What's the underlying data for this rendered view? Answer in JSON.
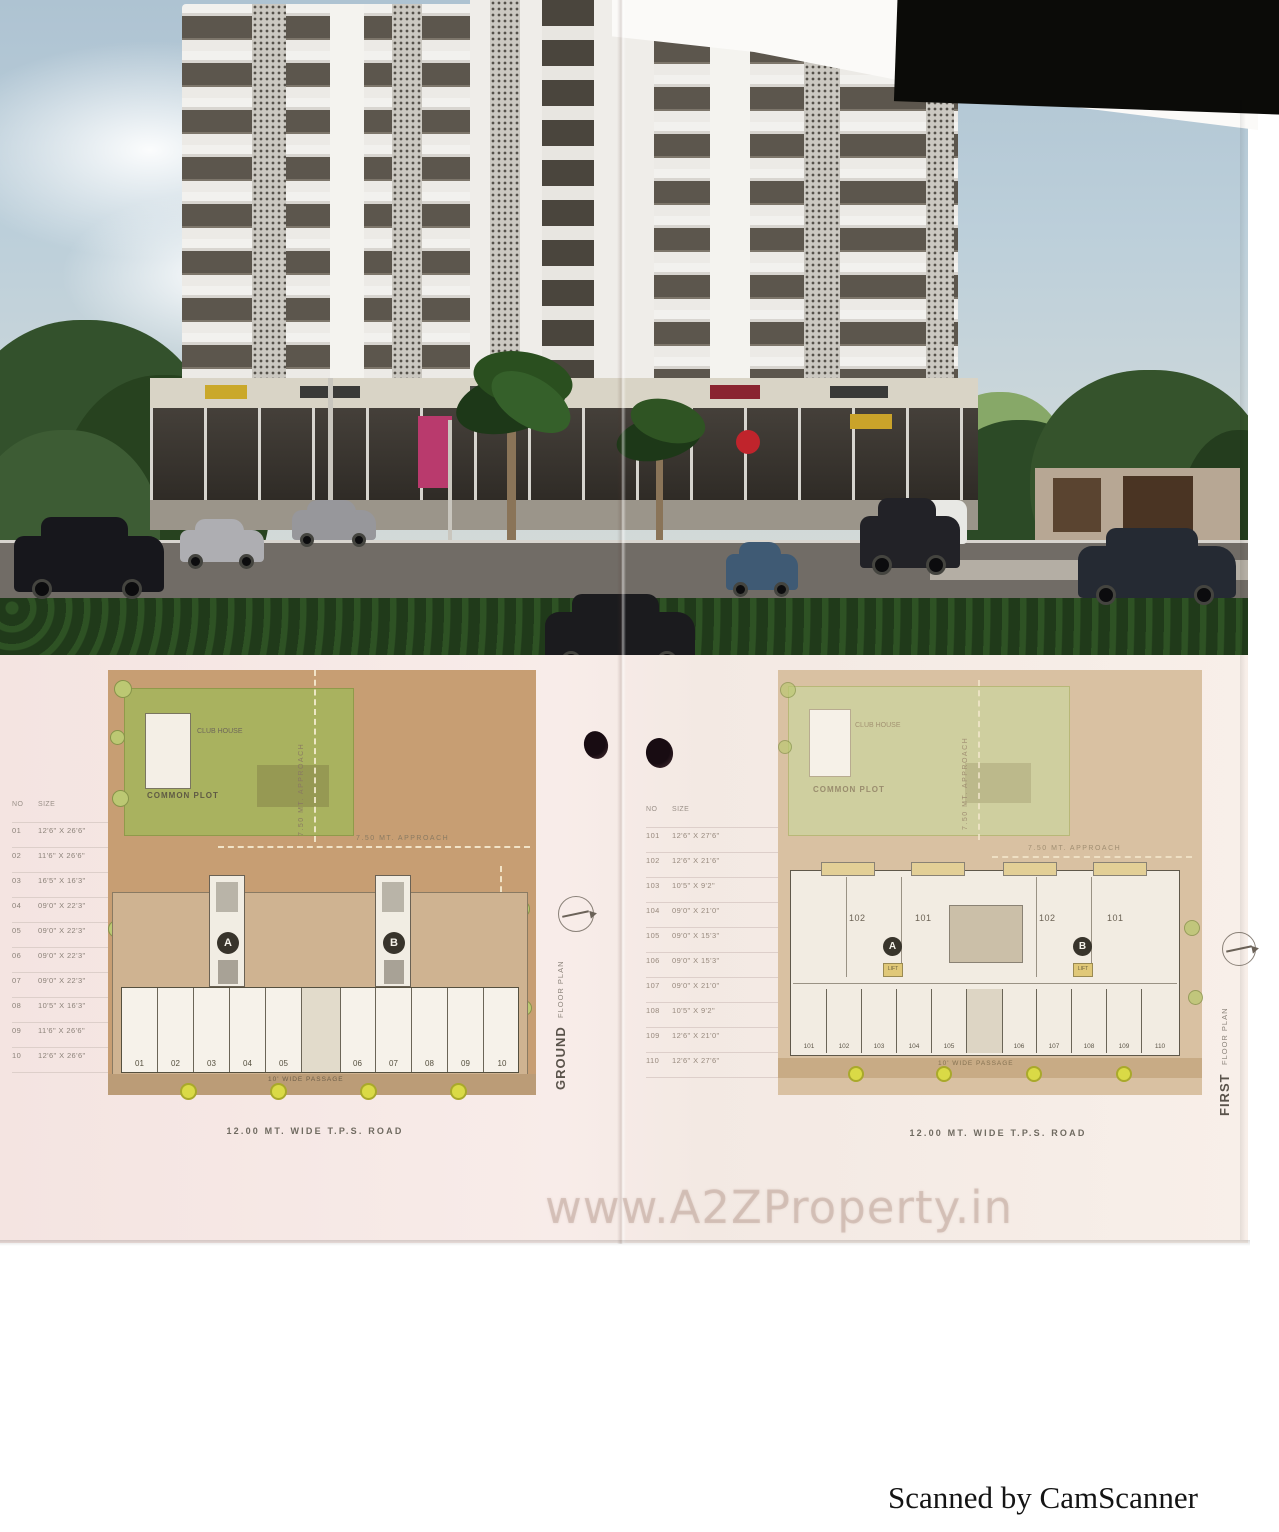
{
  "scan": {
    "watermark": "www.A2ZProperty.in",
    "credit": "Scanned by CamScanner"
  },
  "ground_plan": {
    "title": "GROUND",
    "title_rest": "FLOOR PLAN",
    "road_label": "12.00 MT. WIDE T.P.S. ROAD",
    "approach_label": "7.50 MT. APPROACH",
    "common_plot_label": "COMMON PLOT",
    "club_house_label": "CLUB HOUSE",
    "passage_label": "10' WIDE PASSAGE",
    "tower_a": "A",
    "tower_b": "B",
    "shops": [
      "01",
      "02",
      "03",
      "04",
      "05",
      "06",
      "07",
      "08",
      "09",
      "10"
    ],
    "table": {
      "no_header": "NO",
      "size_header": "SIZE",
      "rows": [
        {
          "no": "01",
          "size": "12'6\" X 26'6\""
        },
        {
          "no": "02",
          "size": "11'6\" X 26'6\""
        },
        {
          "no": "03",
          "size": "16'5\" X 16'3\""
        },
        {
          "no": "04",
          "size": "09'0\" X 22'3\""
        },
        {
          "no": "05",
          "size": "09'0\" X 22'3\""
        },
        {
          "no": "06",
          "size": "09'0\" X 22'3\""
        },
        {
          "no": "07",
          "size": "09'0\" X 22'3\""
        },
        {
          "no": "08",
          "size": "10'5\" X 16'3\""
        },
        {
          "no": "09",
          "size": "11'6\" X 26'6\""
        },
        {
          "no": "10",
          "size": "12'6\" X 26'6\""
        }
      ]
    }
  },
  "first_plan": {
    "title": "FIRST",
    "title_rest": "FLOOR PLAN",
    "road_label": "12.00 MT. WIDE T.P.S. ROAD",
    "approach_label": "7.50 MT. APPROACH",
    "common_plot_label": "COMMON PLOT",
    "club_house_label": "CLUB HOUSE",
    "passage_label": "10' WIDE PASSAGE",
    "lift_label": "LIFT",
    "tower_a": "A",
    "tower_b": "B",
    "units": [
      "102",
      "101",
      "102",
      "101"
    ],
    "rooms": [
      "101",
      "102",
      "103",
      "104",
      "105",
      "106",
      "107",
      "108",
      "109",
      "110"
    ],
    "table": {
      "no_header": "NO",
      "size_header": "SIZE",
      "rows": [
        {
          "no": "101",
          "size": "12'6\" X 27'6\""
        },
        {
          "no": "102",
          "size": "12'6\" X 21'6\""
        },
        {
          "no": "103",
          "size": "10'5\" X 9'2\""
        },
        {
          "no": "104",
          "size": "09'0\" X 21'0\""
        },
        {
          "no": "105",
          "size": "09'0\" X 15'3\""
        },
        {
          "no": "106",
          "size": "09'0\" X 15'3\""
        },
        {
          "no": "107",
          "size": "09'0\" X 21'0\""
        },
        {
          "no": "108",
          "size": "10'5\" X 9'2\""
        },
        {
          "no": "109",
          "size": "12'6\" X 21'0\""
        },
        {
          "no": "110",
          "size": "12'6\" X 27'6\""
        }
      ]
    }
  }
}
